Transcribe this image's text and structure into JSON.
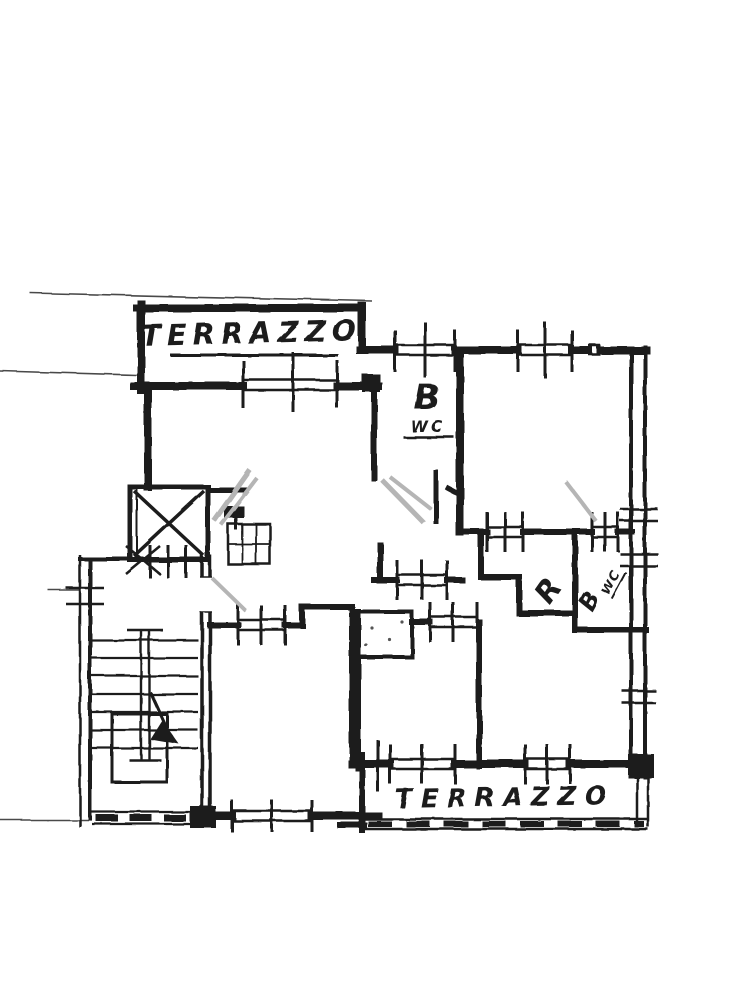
{
  "plan": {
    "kind": "scanned hand-drawn apartment floor plan",
    "labels": {
      "terrace_top": "TERRAZZO",
      "terrace_bottom": "TERRAZZO",
      "bathroom_top_b": "B",
      "bathroom_top_wc": "WC",
      "storage_r": "R",
      "bathroom_right_b": "B",
      "bathroom_right_wc": "WC"
    },
    "symbols": [
      "elevator-cross-icon",
      "staircase-steps-icon",
      "stairs-direction-arrow-icon",
      "door-swing-pencil-marks",
      "window-tick-marks",
      "parapet-hatch-marks"
    ],
    "colors": {
      "ink": "#1b1b1b",
      "pencil_gray": "#b5b5b5",
      "paper": "#ffffff"
    }
  }
}
